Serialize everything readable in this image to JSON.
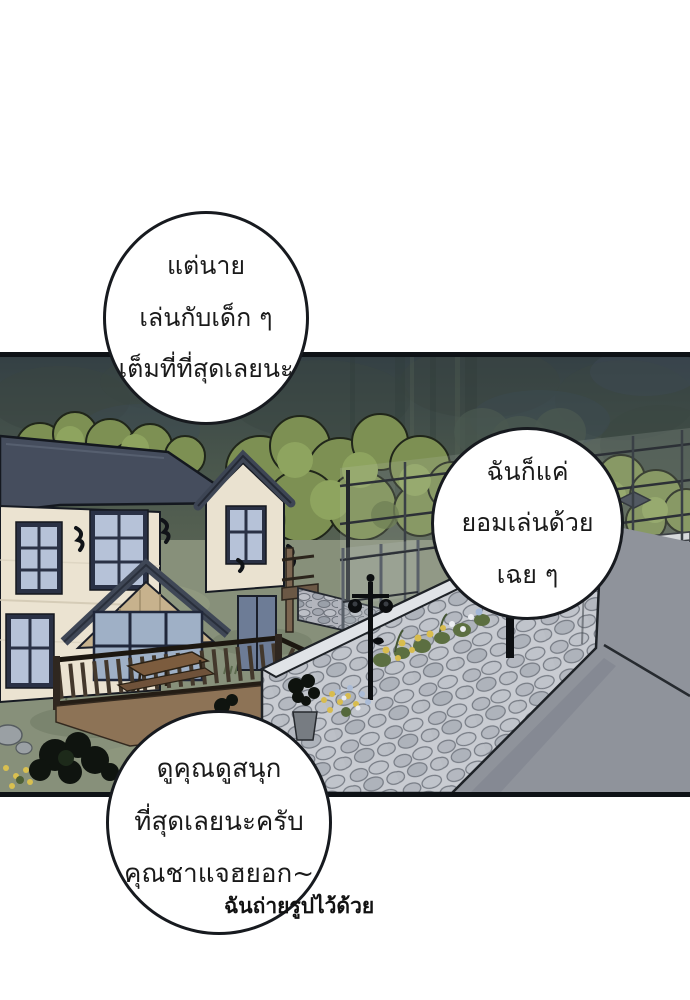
{
  "panel": {
    "type": "comic-panel",
    "border_color": "#0e1216",
    "background": "#ffffff"
  },
  "speech_bubbles": [
    {
      "name": "bubble-top-left",
      "lines": [
        "แต่นาย",
        "เล่นกับเด็ก ๆ",
        "เต็มที่ที่สุดเลยนะ"
      ]
    },
    {
      "name": "bubble-right",
      "lines": [
        "ฉันก็แค่",
        "ยอมเล่นด้วย",
        "เฉย ๆ"
      ]
    },
    {
      "name": "bubble-bottom-left",
      "lines": [
        "ดูคุณดูสนุก",
        "ที่สุดเลยนะครับ",
        "คุณชาแจฮยอก~"
      ]
    }
  ],
  "caption": {
    "text": "ฉันถ่ายรูปไว้ด้วย"
  },
  "scene": {
    "elements": [
      "forest-background",
      "tree-line",
      "two-story-house",
      "porch-deck",
      "picnic-table",
      "tennis-courts",
      "chain-link-fence",
      "street-lamp",
      "stone-wall",
      "flower-bed",
      "garden-plants",
      "road"
    ],
    "palette": {
      "forest_dark": "#414d48",
      "tree_green": "#7d9053",
      "grass_green": "#87907a",
      "court_green": "#abc7b5",
      "stone_gray": "#c9ccd2",
      "road_gray": "#8f939b",
      "house_cream": "#ebe3d1",
      "roof_slate": "#454d5d",
      "outline_black": "#171a1f",
      "bubble_bg": "#ffffff"
    }
  }
}
